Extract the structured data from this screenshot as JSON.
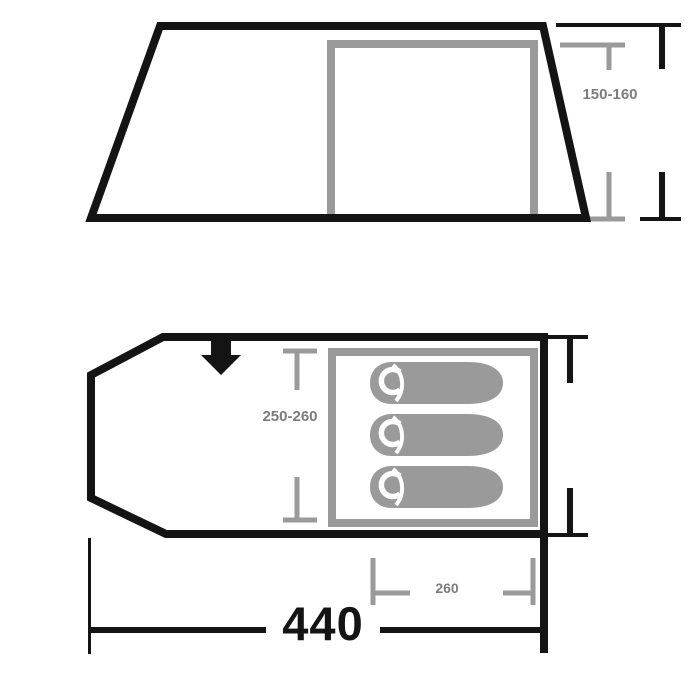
{
  "diagram_title": "Tent dimensions diagram",
  "colors": {
    "outline": "#141414",
    "secondary": "#9a9a9a",
    "label": "#7c7c7c",
    "background": "#ffffff"
  },
  "side_view": {
    "height_range": "150-160"
  },
  "floor_plan": {
    "inner_width_range": "250-260",
    "inner_length": "260",
    "overall_length": "440",
    "sleeping_bag_count": 3
  },
  "icons": {
    "entrance_arrow": "down-arrow-icon",
    "sleeping_bag": "sleeping-bag-icon"
  }
}
